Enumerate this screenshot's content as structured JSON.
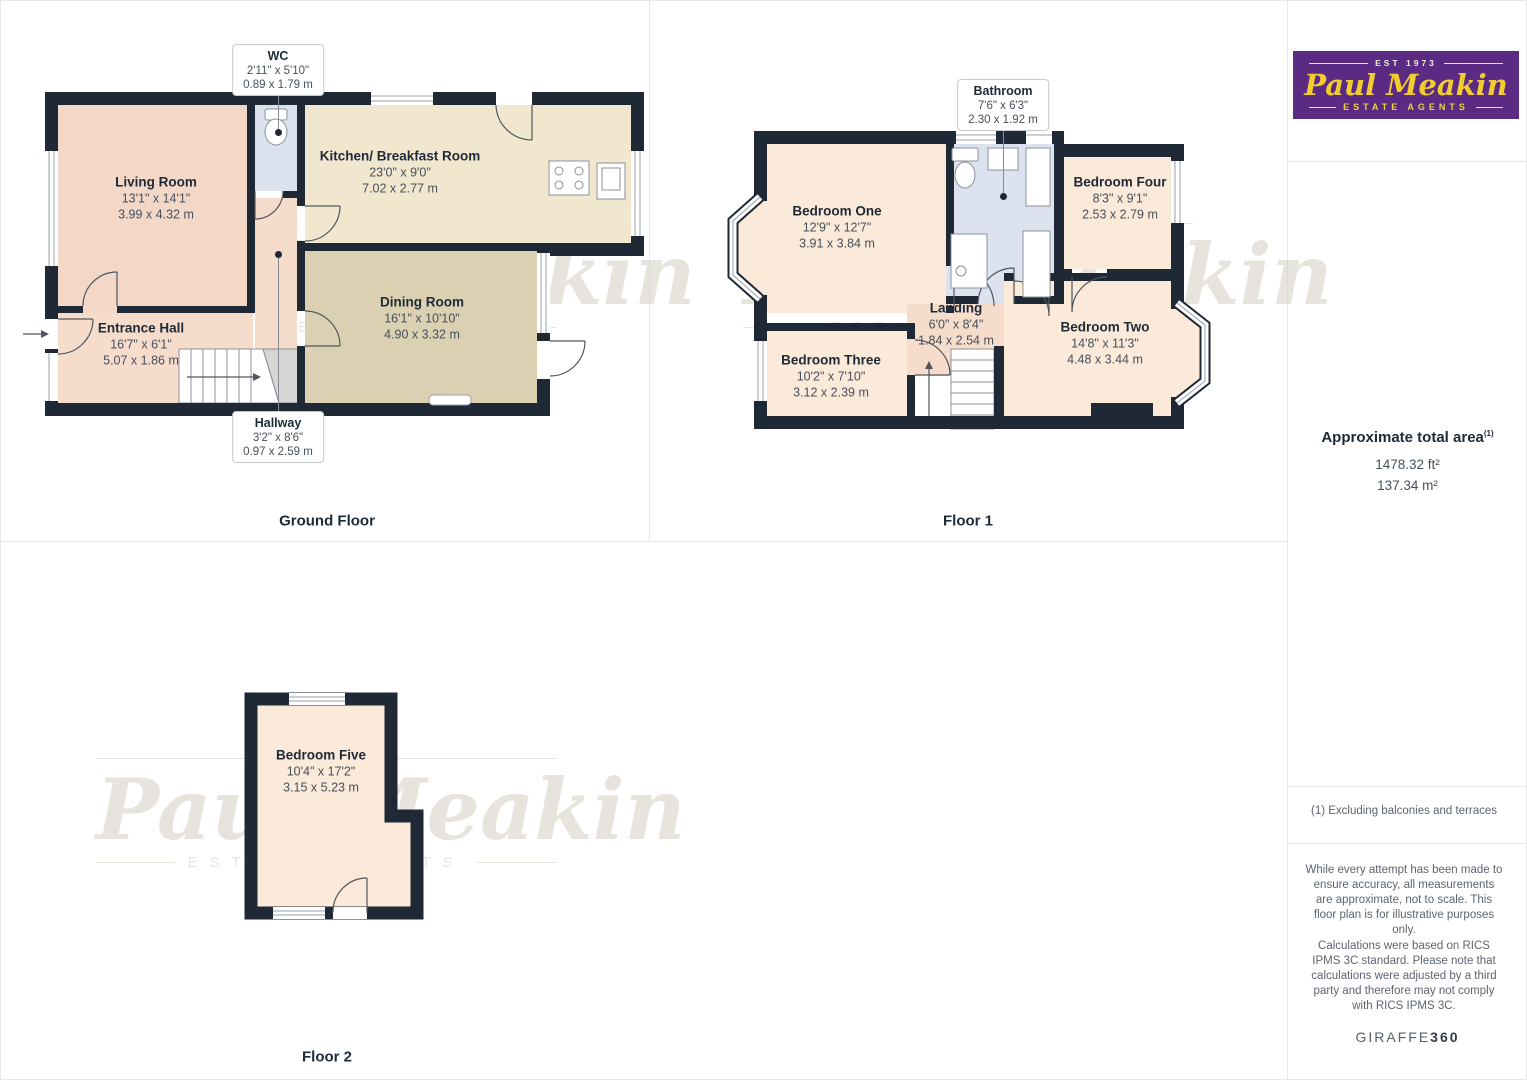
{
  "palette": {
    "wall": "#1f2936",
    "ink": "#1f2a38",
    "dim": "#47505c",
    "muted": "#5b6570",
    "line": "#e7e7e7",
    "pink": "#f3d7c7",
    "pink2": "#f5dccb",
    "cream": "#f1e7cf",
    "tan": "#dbd0b1",
    "peach": "#fbe9d9",
    "blue": "#dce2ee",
    "stair": "#d6d6d6",
    "wm": "#d5cec3",
    "brandPurple": "#5b2a82",
    "brandYellow": "#f2cd30"
  },
  "watermark": {
    "est": "EST 1973",
    "name": "Paul Meakin",
    "tagline": "ESTATE AGENTS"
  },
  "brand": {
    "est": "EST 1973",
    "name": "Paul Meakin",
    "tagline": "ESTATE AGENTS"
  },
  "floors": {
    "ground": {
      "label": "Ground Floor",
      "rooms": {
        "living": {
          "name": "Living Room",
          "imperial": "13'1\" x 14'1\"",
          "metric": "3.99 x 4.32 m"
        },
        "kitchen": {
          "name": "Kitchen/ Breakfast Room",
          "imperial": "23'0\" x 9'0\"",
          "metric": "7.02 x 2.77 m"
        },
        "dining": {
          "name": "Dining Room",
          "imperial": "16'1\" x 10'10\"",
          "metric": "4.90 x 3.32 m"
        },
        "entrance": {
          "name": "Entrance Hall",
          "imperial": "16'7\" x 6'1\"",
          "metric": "5.07 x 1.86 m"
        },
        "wc": {
          "name": "WC",
          "imperial": "2'11\" x 5'10\"",
          "metric": "0.89 x 1.79 m"
        },
        "hallway": {
          "name": "Hallway",
          "imperial": "3'2\" x 8'6\"",
          "metric": "0.97 x 2.59 m"
        }
      }
    },
    "floor1": {
      "label": "Floor 1",
      "rooms": {
        "bedroom_one": {
          "name": "Bedroom One",
          "imperial": "12'9\" x 12'7\"",
          "metric": "3.91 x 3.84 m"
        },
        "bathroom": {
          "name": "Bathroom",
          "imperial": "7'6\" x 6'3\"",
          "metric": "2.30 x 1.92 m"
        },
        "bedroom_four": {
          "name": "Bedroom Four",
          "imperial": "8'3\" x 9'1\"",
          "metric": "2.53 x 2.79 m"
        },
        "landing": {
          "name": "Landing",
          "imperial": "6'0\" x 8'4\"",
          "metric": "1.84 x 2.54 m"
        },
        "bedroom_two": {
          "name": "Bedroom Two",
          "imperial": "14'8\" x 11'3\"",
          "metric": "4.48 x 3.44 m"
        },
        "bedroom_three": {
          "name": "Bedroom Three",
          "imperial": "10'2\" x 7'10\"",
          "metric": "3.12 x 2.39 m"
        }
      }
    },
    "floor2": {
      "label": "Floor 2",
      "rooms": {
        "bedroom_five": {
          "name": "Bedroom Five",
          "imperial": "10'4\" x 17'2\"",
          "metric": "3.15 x 5.23 m"
        }
      }
    }
  },
  "sidebar": {
    "area_title": "Approximate total area",
    "area_footnote_mark": "(1)",
    "area_ft": "1478.32 ft²",
    "area_m": "137.34 m²",
    "footnote": "(1) Excluding balconies and terraces",
    "disclaimer_1": "While every attempt has been made to ensure accuracy, all measurements are approximate, not to scale. This floor plan is for illustrative purposes only.",
    "disclaimer_2": "Calculations were based on RICS IPMS 3C standard. Please note that calculations were adjusted by a third party and therefore may not comply with RICS IPMS 3C.",
    "brand_word": "GIRAFFE",
    "brand_number": "360"
  }
}
